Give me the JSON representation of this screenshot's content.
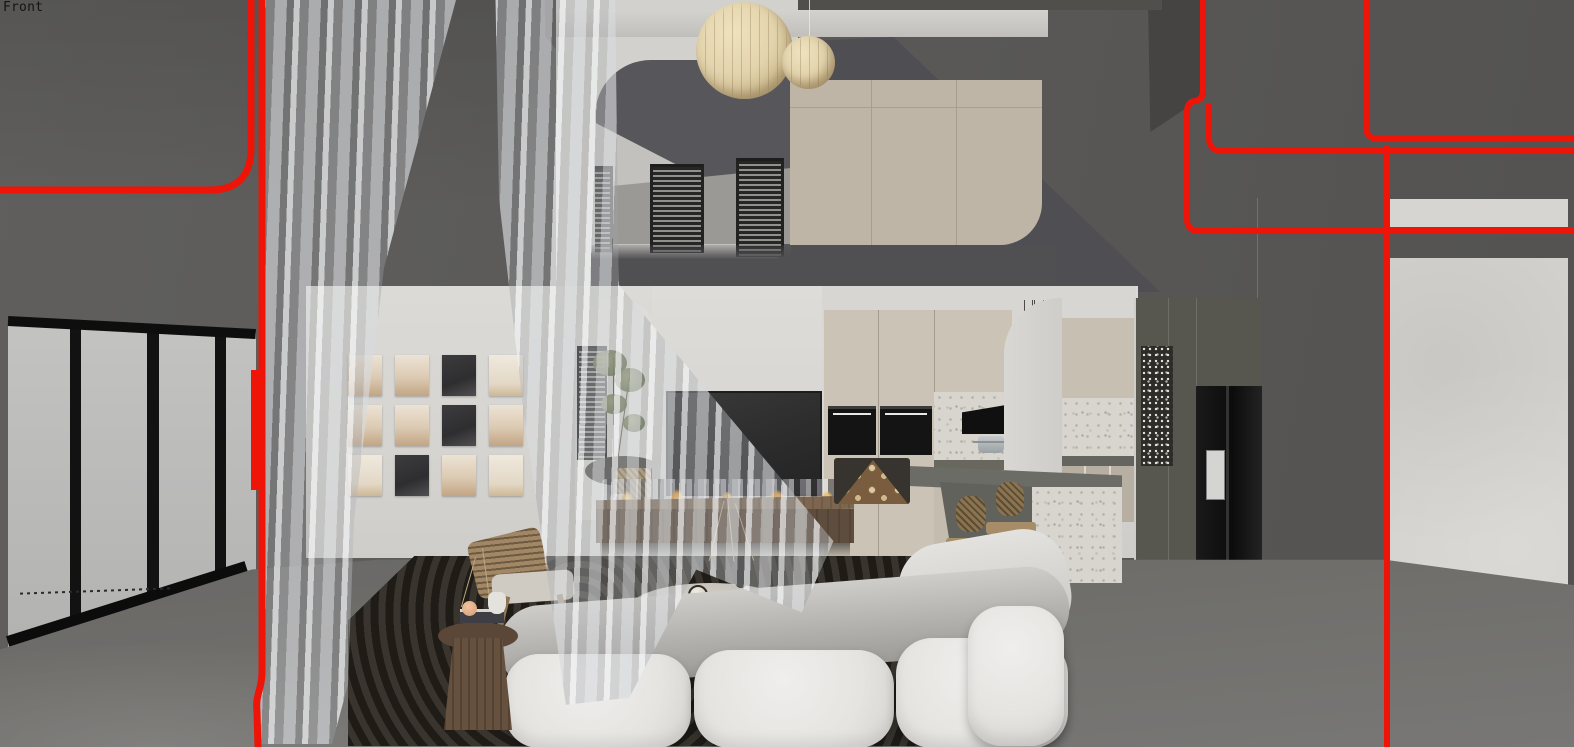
{
  "viewport": {
    "camera_label": "Front"
  },
  "section_cut": {
    "color": "#ee1408"
  },
  "palette": {
    "wall": "#5d5c5a",
    "plaster": "#d8d6d2",
    "glass": "#b7b7b6",
    "cabinet_cream": "#cbc3b5",
    "wardrobe": "#beb5a6",
    "terrazzo": "#d8d5cf",
    "wood_bench": "#6e5a45",
    "rug": "#27241f",
    "sofa": "#e9e8e5",
    "lantern": "#e3d4ad"
  },
  "art_wall": {
    "rows": 3,
    "cols": 4,
    "tones": [
      "sand",
      "sand",
      "dark",
      "cream",
      "sand",
      "sand",
      "dark",
      "sand",
      "cream",
      "dark",
      "sand",
      "cream"
    ]
  },
  "mezzanine": {
    "louver_windows": 3
  },
  "kitchen": {
    "oven_count": 2,
    "stool_count": 2,
    "pendants": [
      {
        "x": 1027,
        "y": 358,
        "w": 13,
        "h": 15
      },
      {
        "x": 1016,
        "y": 373,
        "w": 15,
        "h": 17
      },
      {
        "x": 1040,
        "y": 369,
        "w": 17,
        "h": 19
      },
      {
        "x": 1024,
        "y": 391,
        "w": 16,
        "h": 18
      },
      {
        "x": 1034,
        "y": 404,
        "w": 17,
        "h": 20
      }
    ],
    "pendant_cord_top_y": 300
  },
  "lanterns": [
    {
      "x": 696,
      "y": 2,
      "d": 97
    },
    {
      "x": 782,
      "y": 36,
      "d": 53
    }
  ]
}
